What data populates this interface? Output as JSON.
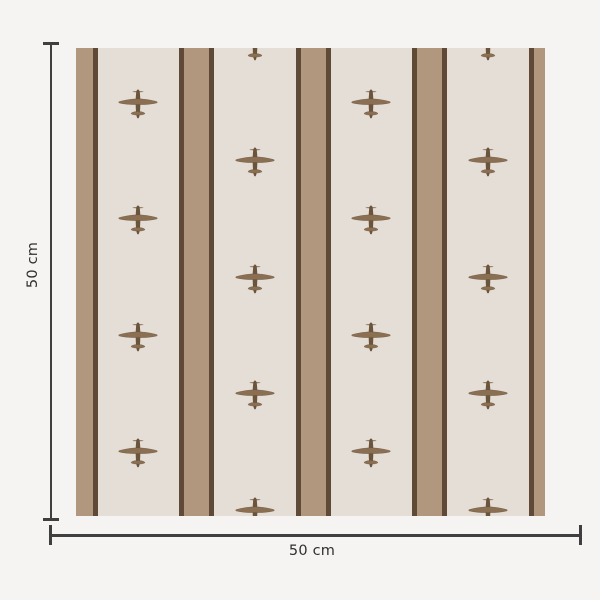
{
  "dimensions": {
    "vertical_label": "50 cm",
    "horizontal_label": "50 cm"
  },
  "colors": {
    "page_background": "#f5f4f2",
    "swatch_background": "#e5ded6",
    "stripe_fill": "#b0977e",
    "stripe_border": "#5e4a37",
    "plane_body": "#8b6f52",
    "plane_fuselage": "#6b543c",
    "plane_outline": "#55422f",
    "dimension_line": "#3f3f3f",
    "label_text": "#2f2f2f"
  },
  "swatch": {
    "motif": "airplane",
    "geometry": {
      "x": 76,
      "y": 48,
      "width": 469,
      "height": 468,
      "stripe_centers": [
        4,
        120.5,
        237,
        353.5,
        470
      ],
      "stripe_width": 25,
      "stripe_border_width": 5,
      "plane_columns": [
        62.25,
        178.75,
        295.25,
        411.75
      ],
      "plane_rows_odd": [
        56.5,
        173,
        289.5,
        406
      ],
      "plane_rows_even": [
        -1.5,
        115,
        231.5,
        348,
        464.5
      ],
      "plane_width": 40,
      "plane_height": 32
    }
  }
}
